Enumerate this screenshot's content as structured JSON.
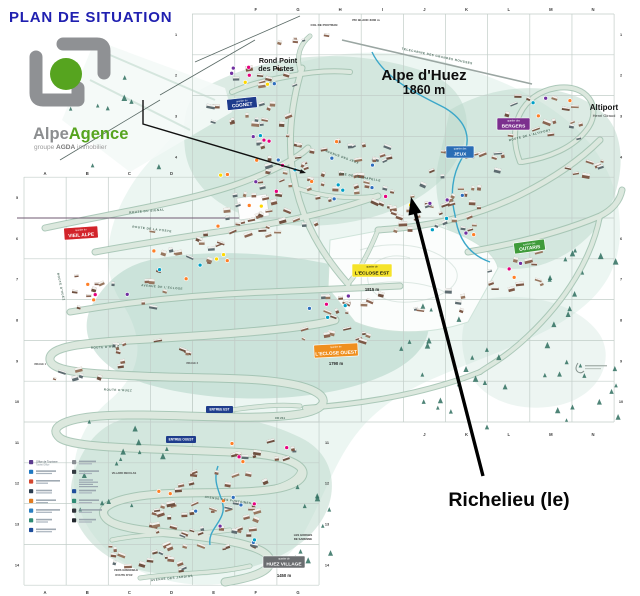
{
  "page": {
    "title": "PLAN DE SITUATION"
  },
  "logo": {
    "part1": "Alpe",
    "part2": "Agence",
    "sub_prefix": "groupe ",
    "sub_brand": "AGDA",
    "sub_suffix": " immobilier",
    "green": "#56a41f",
    "gray": "#8f9194"
  },
  "resort": {
    "name": "Alpe d'Huez",
    "altitude": "1860 m"
  },
  "annotation": {
    "label": "Richelieu (le)"
  },
  "colors": {
    "title": "#2020b0",
    "wash": "#b9d7ca",
    "wash_deep": "#a4cdbd",
    "underlay": "#ddeee8",
    "stream": "#3ba7c9",
    "tree": "#2f6f5f",
    "grid": "#c2cdc8",
    "buildings": [
      "#7d5846",
      "#8a6451",
      "#6e4f3f",
      "#97765f",
      "#5d6b70"
    ],
    "roof": "#f2f1ee",
    "dots": [
      "#e6007e",
      "#ffd800",
      "#00a0c6",
      "#7030a0",
      "#ff7f27",
      "#2e6fbd"
    ]
  },
  "quartier_badges": [
    {
      "id": "cognet",
      "prefix": "quartier du",
      "name": "COGNET",
      "x": 227,
      "y": 98,
      "w": 30,
      "h": 11,
      "bg": "#1e3c8c",
      "fg": "#ffffff",
      "rot": -6
    },
    {
      "id": "jeux",
      "prefix": "quartier des",
      "name": "JEUX",
      "x": 446,
      "y": 146,
      "w": 28,
      "h": 12,
      "bg": "#2a6db5",
      "fg": "#ffffff",
      "rot": 0
    },
    {
      "id": "bergers",
      "prefix": "quartier des",
      "name": "BERGERS",
      "x": 497,
      "y": 118,
      "w": 33,
      "h": 12,
      "bg": "#7b2f8e",
      "fg": "#ffffff",
      "rot": 0
    },
    {
      "id": "vieil-alpe",
      "prefix": "quartier du",
      "name": "VIEIL ALPE",
      "x": 64,
      "y": 227,
      "w": 34,
      "h": 12,
      "bg": "#d2232a",
      "fg": "#ffffff",
      "rot": -4
    },
    {
      "id": "outaris",
      "prefix": "quartier des",
      "name": "OUTARIS",
      "x": 514,
      "y": 241,
      "w": 31,
      "h": 11,
      "bg": "#3f9b3a",
      "fg": "#ffffff",
      "rot": -8
    },
    {
      "id": "eclose-est",
      "prefix": "quartier de",
      "name": "L'ECLOSE EST",
      "x": 352,
      "y": 264,
      "w": 40,
      "h": 13,
      "bg": "#f5e32a",
      "fg": "#111111",
      "rot": 0,
      "alt": "1815 m",
      "altx": 372,
      "alty": 291
    },
    {
      "id": "eclose-ouest",
      "prefix": "quartier de",
      "name": "L'ECLOSE OUEST",
      "x": 314,
      "y": 344,
      "w": 44,
      "h": 13,
      "bg": "#ef8f1f",
      "fg": "#ffffff",
      "rot": -3,
      "alt": "1790 m",
      "altx": 336,
      "alty": 365
    },
    {
      "id": "huez-village",
      "prefix": "quartier de",
      "name": "HUEZ VILLAGE",
      "x": 263,
      "y": 556,
      "w": 42,
      "h": 12,
      "bg": "#6b6d70",
      "fg": "#ffffff",
      "rot": 0,
      "alt": "1450 m",
      "altx": 284,
      "alty": 577
    }
  ],
  "entry_badges": [
    {
      "name": "ENTREE EST",
      "x": 206,
      "y": 406,
      "w": 27,
      "h": 7,
      "bg": "#1e3c8c",
      "fg": "#ffffff"
    },
    {
      "name": "ENTREE OUEST",
      "x": 166,
      "y": 436,
      "w": 30,
      "h": 7,
      "bg": "#1e3c8c",
      "fg": "#ffffff"
    }
  ],
  "places": [
    {
      "t": "Rond Point",
      "x": 278,
      "y": 63,
      "s": 7.2,
      "w": 700,
      "c": "#1b1b1b"
    },
    {
      "t": "des Pistes",
      "x": 276,
      "y": 71,
      "s": 7.2,
      "w": 700,
      "c": "#1b1b1b"
    },
    {
      "t": "Altiport",
      "x": 604,
      "y": 110,
      "s": 8,
      "w": 700,
      "c": "#111111"
    },
    {
      "t": "Henri Giraud",
      "x": 604,
      "y": 117,
      "s": 4,
      "w": 400,
      "c": "#333333"
    },
    {
      "t": "COL DE POUTRAN",
      "x": 324,
      "y": 26,
      "s": 3,
      "w": 700,
      "c": "#333333"
    },
    {
      "t": "PIC BLANC 3330 m",
      "x": 366,
      "y": 21,
      "s": 3,
      "w": 700,
      "c": "#333333"
    },
    {
      "t": "LES GORGES",
      "x": 303,
      "y": 536,
      "s": 2.8,
      "w": 600,
      "c": "#333333"
    },
    {
      "t": "DE SARENNE",
      "x": 303,
      "y": 540,
      "s": 2.8,
      "w": 600,
      "c": "#333333"
    },
    {
      "t": "VILLARD RECULAS",
      "x": 124,
      "y": 474,
      "s": 2.6,
      "w": 600,
      "c": "#444444"
    },
    {
      "t": "VERS GRENOBLE",
      "x": 126,
      "y": 571,
      "s": 2.8,
      "w": 600,
      "c": "#444444"
    },
    {
      "t": "ROUTE D'OZ",
      "x": 124,
      "y": 576,
      "s": 2.8,
      "w": 600,
      "c": "#444444"
    },
    {
      "t": "CD 211",
      "x": 280,
      "y": 419,
      "s": 3,
      "w": 600,
      "c": "#4a6a5c"
    },
    {
      "t": "VIRAGE 1",
      "x": 40,
      "y": 365,
      "s": 2.6,
      "w": 600,
      "c": "#555555"
    },
    {
      "t": "VIRAGE 2",
      "x": 192,
      "y": 364,
      "s": 2.6,
      "w": 600,
      "c": "#555555"
    }
  ],
  "road_labels": [
    {
      "t": "ROUTE DU SIGNAL",
      "x": 147,
      "y": 212,
      "r": -5
    },
    {
      "t": "ROUTE DE LA POSTE",
      "x": 152,
      "y": 230,
      "r": 7
    },
    {
      "t": "AVENUE DE L'ECLOSE",
      "x": 162,
      "y": 288,
      "r": 5
    },
    {
      "t": "AVENUE DES JEUX",
      "x": 342,
      "y": 158,
      "r": 20
    },
    {
      "t": "RUE DE LA CHAPELLE",
      "x": 360,
      "y": 178,
      "r": 10
    },
    {
      "t": "ROUTE DE L'ALTIPORT",
      "x": 530,
      "y": 136,
      "r": -14
    },
    {
      "t": "ROUTE D'HUEZ",
      "x": 105,
      "y": 348,
      "r": -3
    },
    {
      "t": "ROUTE D'HUEZ",
      "x": 118,
      "y": 391,
      "r": 2
    },
    {
      "t": "ROUTE D'HUEZ",
      "x": 60,
      "y": 287,
      "r": 78
    },
    {
      "t": "AVENUE DES FONTAINES",
      "x": 228,
      "y": 501,
      "r": 8
    },
    {
      "t": "AVENUE DES JARDINS",
      "x": 172,
      "y": 579,
      "r": -6
    },
    {
      "t": "TELECABINE DES GRANDES ROUSSES",
      "x": 437,
      "y": 57,
      "r": 12
    }
  ],
  "grid": {
    "x0": 24,
    "col_w": 42.15,
    "y0": 14,
    "row_h": 40.8,
    "cols": 14,
    "rows": 14,
    "blocks": [
      {
        "x1": 192,
        "y1": 14,
        "x2": 614,
        "y2": 422
      },
      {
        "x1": 24,
        "y1": 177,
        "x2": 319,
        "y2": 585
      }
    ],
    "letter_rows": [
      {
        "y": 8,
        "items": [
          "F",
          "G",
          "H",
          "I",
          "J",
          "K",
          "L",
          "M",
          "N"
        ]
      },
      {
        "y": 172,
        "items": [
          "A",
          "B",
          "C",
          "D"
        ]
      },
      {
        "y": 433,
        "items": [
          "J",
          "K",
          "L",
          "M",
          "N"
        ]
      },
      {
        "y": 591,
        "items": [
          "A",
          "B",
          "C",
          "D",
          "E",
          "F",
          "G"
        ]
      }
    ],
    "number_cols": [
      {
        "x": 176,
        "from": 1,
        "to": 4
      },
      {
        "x": 621,
        "from": 1,
        "to": 10
      },
      {
        "x": 17,
        "from": 5,
        "to": 14
      },
      {
        "x": 327,
        "from": 11,
        "to": 14
      }
    ],
    "alphabet": "ABCDEFGHIJKLMN"
  },
  "legend": {
    "first_item": {
      "label_fr": "Office de Tourisme",
      "label_en": "Tourist Office"
    },
    "left_icons": [
      "#5b3a8e",
      "#1f78c1",
      "#d4472f",
      "#2c3e50",
      "#e07b20",
      "#2a7fc1",
      "#2e8b74",
      "#1f4e9c"
    ],
    "right_icons": [
      "#8a8f94",
      "#333a40",
      "none",
      "#1f4e9c",
      "#2e8b74",
      "#30343a",
      "#23282e"
    ]
  },
  "map_art": {
    "seed": 11,
    "clusters": [
      {
        "x": 268,
        "y": 78,
        "rx": 38,
        "ry": 12,
        "n": 10
      },
      {
        "x": 250,
        "y": 120,
        "rx": 45,
        "ry": 18,
        "n": 16
      },
      {
        "x": 300,
        "y": 38,
        "rx": 28,
        "ry": 8,
        "n": 5
      },
      {
        "x": 320,
        "y": 165,
        "rx": 70,
        "ry": 28,
        "n": 40
      },
      {
        "x": 280,
        "y": 215,
        "rx": 55,
        "ry": 25,
        "n": 28
      },
      {
        "x": 420,
        "y": 200,
        "rx": 65,
        "ry": 22,
        "n": 30
      },
      {
        "x": 470,
        "y": 165,
        "rx": 40,
        "ry": 15,
        "n": 12
      },
      {
        "x": 185,
        "y": 245,
        "rx": 40,
        "ry": 20,
        "n": 14
      },
      {
        "x": 115,
        "y": 290,
        "rx": 50,
        "ry": 22,
        "n": 14
      },
      {
        "x": 90,
        "y": 370,
        "rx": 40,
        "ry": 10,
        "n": 8
      },
      {
        "x": 355,
        "y": 305,
        "rx": 45,
        "ry": 14,
        "n": 12
      },
      {
        "x": 330,
        "y": 335,
        "rx": 40,
        "ry": 8,
        "n": 9
      },
      {
        "x": 545,
        "y": 115,
        "rx": 38,
        "ry": 28,
        "n": 16
      },
      {
        "x": 590,
        "y": 165,
        "rx": 22,
        "ry": 12,
        "n": 7
      },
      {
        "x": 510,
        "y": 270,
        "rx": 32,
        "ry": 22,
        "n": 11
      },
      {
        "x": 440,
        "y": 300,
        "rx": 25,
        "ry": 12,
        "n": 6
      },
      {
        "x": 150,
        "y": 345,
        "rx": 45,
        "ry": 10,
        "n": 8
      },
      {
        "x": 255,
        "y": 450,
        "rx": 40,
        "ry": 12,
        "n": 11
      },
      {
        "x": 225,
        "y": 480,
        "rx": 50,
        "ry": 12,
        "n": 10
      },
      {
        "x": 205,
        "y": 525,
        "rx": 55,
        "ry": 28,
        "n": 42
      },
      {
        "x": 150,
        "y": 558,
        "rx": 40,
        "ry": 14,
        "n": 16
      },
      {
        "x": 440,
        "y": 225,
        "rx": 50,
        "ry": 10,
        "n": 10
      }
    ],
    "dot_areas": [
      {
        "x": 265,
        "y": 75,
        "rx": 40,
        "ry": 12,
        "n": 7
      },
      {
        "x": 300,
        "y": 170,
        "rx": 80,
        "ry": 40,
        "n": 22
      },
      {
        "x": 180,
        "y": 255,
        "rx": 55,
        "ry": 30,
        "n": 8
      },
      {
        "x": 420,
        "y": 210,
        "rx": 60,
        "ry": 25,
        "n": 9
      },
      {
        "x": 350,
        "y": 310,
        "rx": 45,
        "ry": 15,
        "n": 5
      },
      {
        "x": 540,
        "y": 120,
        "rx": 35,
        "ry": 25,
        "n": 4
      },
      {
        "x": 210,
        "y": 520,
        "rx": 55,
        "ry": 30,
        "n": 10
      },
      {
        "x": 120,
        "y": 300,
        "rx": 40,
        "ry": 20,
        "n": 4
      },
      {
        "x": 505,
        "y": 265,
        "rx": 28,
        "ry": 18,
        "n": 3
      },
      {
        "x": 255,
        "y": 452,
        "rx": 40,
        "ry": 10,
        "n": 4
      }
    ],
    "tree_areas": [
      {
        "x1": 540,
        "y1": 240,
        "x2": 620,
        "y2": 420,
        "n": 26
      },
      {
        "x1": 390,
        "y1": 300,
        "x2": 520,
        "y2": 430,
        "n": 22
      },
      {
        "x1": 290,
        "y1": 470,
        "x2": 340,
        "y2": 560,
        "n": 10
      },
      {
        "x1": 60,
        "y1": 410,
        "x2": 170,
        "y2": 540,
        "n": 14
      },
      {
        "x1": 60,
        "y1": 60,
        "x2": 170,
        "y2": 170,
        "n": 8
      }
    ]
  }
}
